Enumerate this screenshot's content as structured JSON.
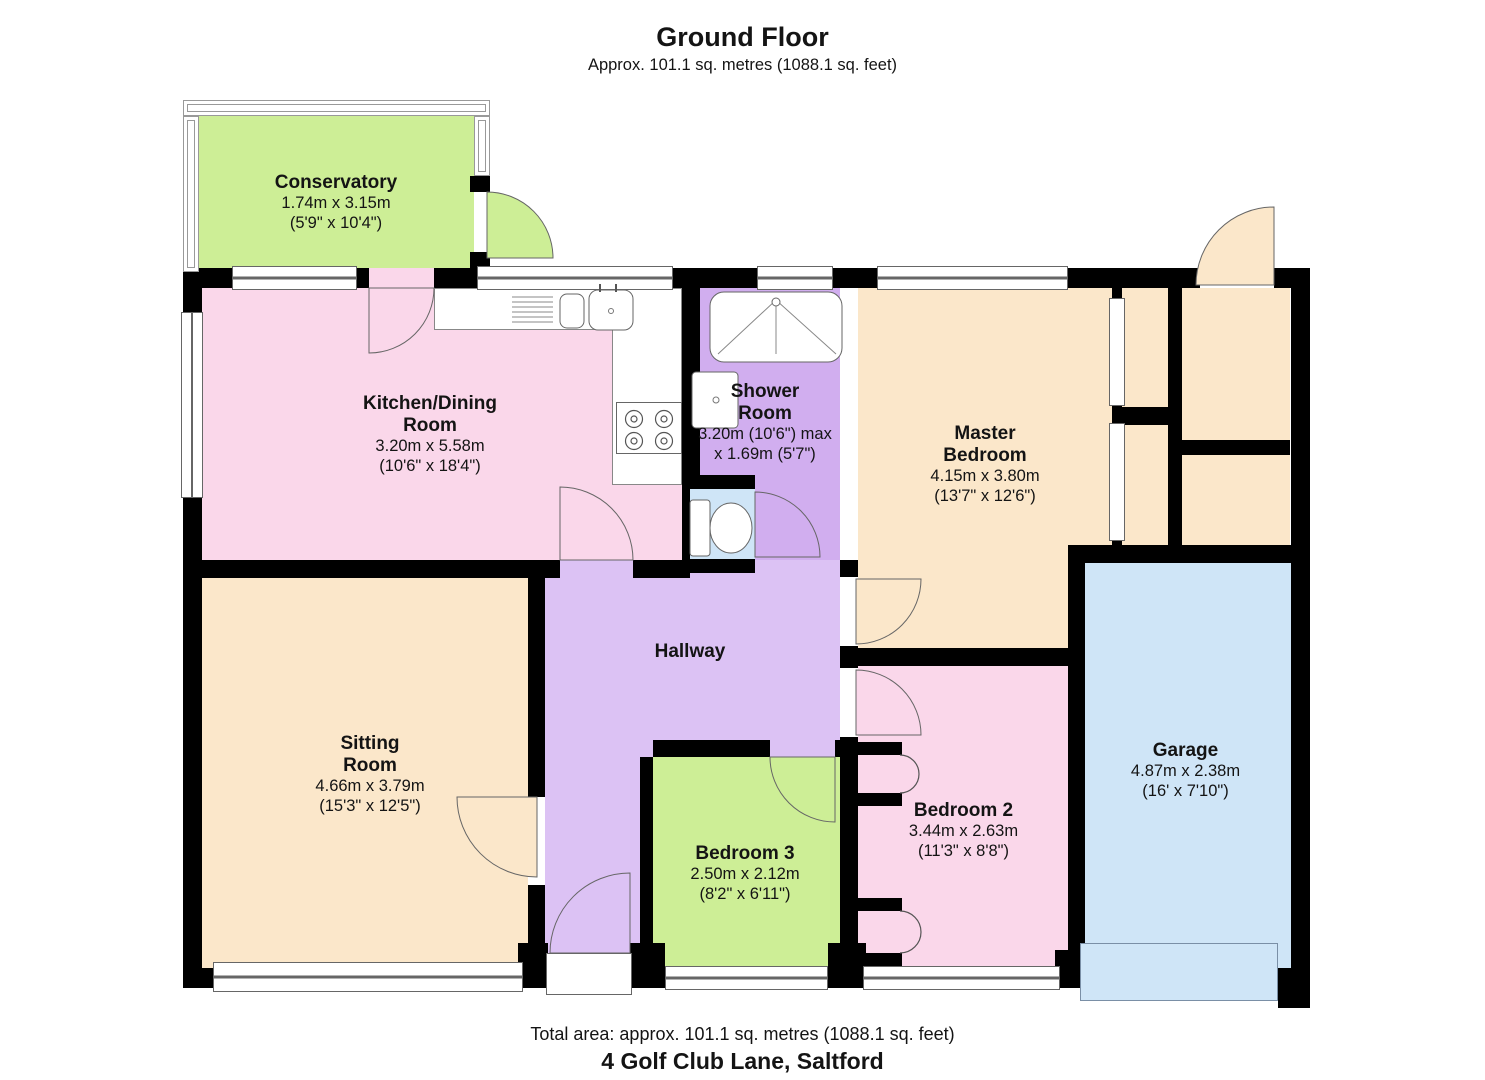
{
  "header": {
    "title": "Ground Floor",
    "subtitle": "Approx. 101.1 sq. metres (1088.1 sq. feet)"
  },
  "footer": {
    "total_area": "Total area: approx. 101.1 sq. metres (1088.1 sq. feet)",
    "address": "4 Golf Club Lane, Saltford"
  },
  "rooms": {
    "conservatory": {
      "name": "Conservatory",
      "metric": "1.74m x 3.15m",
      "imperial": "(5'9\" x 10'4\")"
    },
    "kitchen": {
      "name": "Kitchen/Dining Room",
      "metric": "3.20m x 5.58m",
      "imperial": "(10'6\" x 18'4\")"
    },
    "shower": {
      "name": "Shower Room",
      "metric": "3.20m (10'6\") max",
      "imperial": "x 1.69m (5'7\")"
    },
    "master": {
      "name": "Master Bedroom",
      "metric": "4.15m x 3.80m",
      "imperial": "(13'7\" x 12'6\")"
    },
    "sitting": {
      "name": "Sitting Room",
      "metric": "4.66m x 3.79m",
      "imperial": "(15'3\" x 12'5\")"
    },
    "hallway": {
      "name": "Hallway"
    },
    "bed3": {
      "name": "Bedroom 3",
      "metric": "2.50m x 2.12m",
      "imperial": "(8'2\" x 6'11\")"
    },
    "bed2": {
      "name": "Bedroom 2",
      "metric": "3.44m x 2.63m",
      "imperial": "(11'3\" x 8'8\")"
    },
    "garage": {
      "name": "Garage",
      "metric": "4.87m x 2.38m",
      "imperial": "(16' x 7'10\")"
    }
  },
  "colors": {
    "green": "#cdee96",
    "pink": "#fad7ea",
    "purple": "#dcc2f4",
    "purpledeep": "#d1aeef",
    "cream": "#fbe7ca",
    "blue": "#cfe5f7",
    "wall": "#000000"
  }
}
